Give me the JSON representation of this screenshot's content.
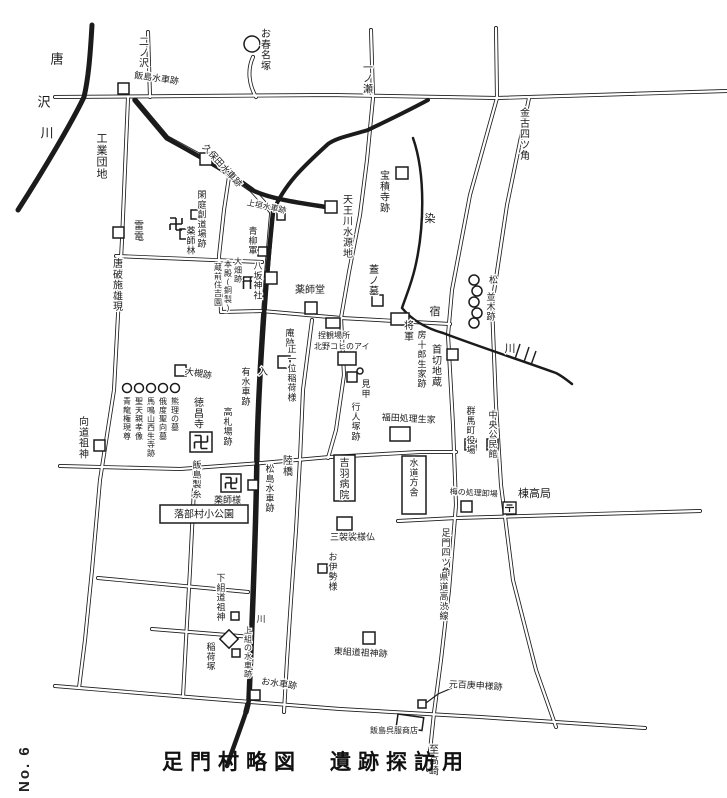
{
  "page": {
    "title": "足門村略図　遺跡探訪用",
    "page_no": "No. 6"
  },
  "colors": {
    "ink": "#1b1b1b",
    "paper": "#ffffff"
  },
  "map": {
    "rivers": [
      {
        "d": "M92,25 C90,60 88,80 84,97 C72,122 45,168 18,210",
        "w": 5
      },
      {
        "d": "M135,100 C150,118 158,128 167,138 C190,152 230,172 252,190 C270,199 300,203 326,207",
        "w": 4.5
      },
      {
        "d": "M428,100 C400,115 380,124 368,130 C348,136 336,138 328,144 C305,165 284,184 273,212",
        "w": 4
      },
      {
        "d": "M273,212 C265,290 259,370 257,450 C256,540 252,620 249,700 L246,712 C240,730 233,748 227,766",
        "w": 4.5
      },
      {
        "d": "M413,138 C426,175 424,230 415,268 C411,285 406,296 402,308 C412,320 425,328 443,333 C480,347 520,360 556,373 C562,376 567,380 572,384",
        "w": 2.5
      }
    ],
    "roads": [
      {
        "d": "M55,97 L330,95 L497,98 L727,91",
        "w": 4
      },
      {
        "d": "M148,32 L150,97",
        "w": 4
      },
      {
        "d": "M253,57 C247,70 249,85 256,97",
        "w": 4
      },
      {
        "d": "M371,30 L373,97",
        "w": 4
      },
      {
        "d": "M496,28 L497,98",
        "w": 4
      },
      {
        "d": "M497,98 L470,195 L452,290 L448,335 L453,425 L456,505 L449,590 L441,660 L434,713 L428,770",
        "w": 4
      },
      {
        "d": "M529,98 L507,205 L492,305 L496,405 L501,485 L513,580 L536,670 L556,727",
        "w": 4
      },
      {
        "d": "M373,98 L367,160 L360,215 L349,272 L341,318",
        "w": 4
      },
      {
        "d": "M341,318 L344,375 L336,430 L328,458",
        "w": 4
      },
      {
        "d": "M262,311 L341,318",
        "w": 4
      },
      {
        "d": "M341,318 L450,324",
        "w": 4
      },
      {
        "d": "M116,256 L262,262",
        "w": 4
      },
      {
        "d": "M60,466 L180,469 L262,463 L330,457 L420,452 L456,452",
        "w": 4
      },
      {
        "d": "M398,521 L456,518 L700,511",
        "w": 4
      },
      {
        "d": "M98,578 L248,592",
        "w": 4
      },
      {
        "d": "M152,629 L252,637",
        "w": 4
      },
      {
        "d": "M55,686 L200,698 L340,709 L480,717 L645,728",
        "w": 4
      },
      {
        "d": "M128,98 L122,240 L114,390 L100,480 L92,570 L85,640 L79,688",
        "w": 4
      },
      {
        "d": "M195,468 L190,570 L186,640 L183,697",
        "w": 4
      },
      {
        "d": "M312,320 L303,390 L300,459 L296,530 L291,600 L287,660 L284,712",
        "w": 4
      },
      {
        "d": "M230,170 L224,210 L219,256",
        "w": 4
      },
      {
        "d": "M219,256 L221,312 L262,311",
        "w": 4
      },
      {
        "d": "M272,212 C265,290 259,370 257,450 C256,540 252,620 249,700 L246,712",
        "w": 5.5
      },
      {
        "d": "M135,100 L167,138 L213,163 L252,190 L272,212",
        "w": 5.5
      }
    ],
    "labels": [
      {
        "t": "唐",
        "x": 57,
        "y": 52,
        "o": "v",
        "s": 13
      },
      {
        "t": "沢",
        "x": 44,
        "y": 95,
        "o": "v",
        "s": 13
      },
      {
        "t": "川",
        "x": 47,
        "y": 126,
        "o": "v",
        "s": 13
      },
      {
        "t": "二ノ沢",
        "x": 144,
        "y": 36,
        "o": "v",
        "s": 10
      },
      {
        "t": "お春名塚",
        "x": 266,
        "y": 28,
        "o": "v",
        "s": 10
      },
      {
        "t": "飯島水車跡",
        "x": 135,
        "y": 70,
        "o": "h",
        "s": 9,
        "r": 8
      },
      {
        "t": "一ノ瀬",
        "x": 368,
        "y": 62,
        "o": "v",
        "s": 10
      },
      {
        "t": "金古四ツ角",
        "x": 525,
        "y": 107,
        "o": "v",
        "s": 10
      },
      {
        "t": "工業団地",
        "x": 102,
        "y": 132,
        "o": "v",
        "s": 11
      },
      {
        "t": "久保田水車跡",
        "x": 208,
        "y": 142,
        "o": "h",
        "s": 9,
        "r": 48
      },
      {
        "t": "宝積寺跡",
        "x": 385,
        "y": 170,
        "o": "v",
        "s": 10
      },
      {
        "t": "染",
        "x": 430,
        "y": 212,
        "o": "v",
        "s": 11
      },
      {
        "t": "天王川水源地",
        "x": 348,
        "y": 194,
        "o": "v",
        "s": 10
      },
      {
        "t": "上垣水車跡",
        "x": 248,
        "y": 198,
        "o": "h",
        "s": 8,
        "r": 12
      },
      {
        "t": "青柳軍",
        "x": 253,
        "y": 226,
        "o": "v",
        "s": 9
      },
      {
        "t": "閑庭創道場跡",
        "x": 202,
        "y": 190,
        "o": "v",
        "s": 9
      },
      {
        "t": "雷電",
        "x": 139,
        "y": 220,
        "o": "v",
        "s": 10
      },
      {
        "t": "唐破施雄現",
        "x": 118,
        "y": 258,
        "o": "v",
        "s": 10
      },
      {
        "t": "薬師林",
        "x": 191,
        "y": 226,
        "o": "v",
        "s": 9
      },
      {
        "t": "大畑跡",
        "x": 238,
        "y": 257,
        "o": "v",
        "s": 8
      },
      {
        "t": "本殿(銅製)",
        "x": 228,
        "y": 260,
        "o": "v",
        "s": 8
      },
      {
        "t": "蔵前住吉園",
        "x": 218,
        "y": 263,
        "o": "v",
        "s": 8
      },
      {
        "t": "八坂神社",
        "x": 258,
        "y": 261,
        "o": "v",
        "s": 9
      },
      {
        "t": "薬師堂",
        "x": 295,
        "y": 284,
        "o": "h",
        "s": 10
      },
      {
        "t": "蓋ノ墓",
        "x": 374,
        "y": 264,
        "o": "v",
        "s": 10
      },
      {
        "t": "宿",
        "x": 435,
        "y": 305,
        "o": "v",
        "s": 11
      },
      {
        "t": "将軍",
        "x": 409,
        "y": 320,
        "o": "v",
        "s": 10
      },
      {
        "t": "房十郎生家跡",
        "x": 422,
        "y": 330,
        "o": "v",
        "s": 9
      },
      {
        "t": "首切地蔵",
        "x": 437,
        "y": 344,
        "o": "v",
        "s": 10
      },
      {
        "t": "庵跡",
        "x": 290,
        "y": 328,
        "o": "v",
        "s": 9
      },
      {
        "t": "正一位稲荷様",
        "x": 292,
        "y": 344,
        "o": "v",
        "s": 9
      },
      {
        "t": "捏観場所",
        "x": 318,
        "y": 331,
        "o": "h",
        "s": 8
      },
      {
        "t": "北野コヒのアイ",
        "x": 314,
        "y": 342,
        "o": "h",
        "s": 8
      },
      {
        "t": "見甲",
        "x": 366,
        "y": 379,
        "o": "v",
        "s": 9
      },
      {
        "t": "行人塚跡",
        "x": 356,
        "y": 402,
        "o": "v",
        "s": 9
      },
      {
        "t": "福田処理生家",
        "x": 382,
        "y": 412,
        "o": "h",
        "s": 9,
        "r": 3
      },
      {
        "t": "入",
        "x": 263,
        "y": 366,
        "o": "v",
        "s": 10
      },
      {
        "t": "有水車跡",
        "x": 246,
        "y": 367,
        "o": "v",
        "s": 9
      },
      {
        "t": "大槻跡",
        "x": 186,
        "y": 366,
        "o": "h",
        "s": 9,
        "r": 10
      },
      {
        "t": "徳昌寺",
        "x": 199,
        "y": 397,
        "o": "v",
        "s": 10
      },
      {
        "t": "高札場跡",
        "x": 228,
        "y": 407,
        "o": "v",
        "s": 9
      },
      {
        "t": "向道祖神",
        "x": 84,
        "y": 416,
        "o": "v",
        "s": 10
      },
      {
        "t": "熊理の墓",
        "x": 175,
        "y": 397,
        "o": "v",
        "s": 8
      },
      {
        "t": "俄度聖向墓",
        "x": 163,
        "y": 397,
        "o": "v",
        "s": 8
      },
      {
        "t": "馬鳴山西生寺跡",
        "x": 151,
        "y": 397,
        "o": "v",
        "s": 8
      },
      {
        "t": "聖天親孝像",
        "x": 139,
        "y": 397,
        "o": "v",
        "s": 8
      },
      {
        "t": "青龍権現尊",
        "x": 127,
        "y": 397,
        "o": "v",
        "s": 8
      },
      {
        "t": "群馬町役場",
        "x": 471,
        "y": 406,
        "o": "v",
        "s": 9
      },
      {
        "t": "中央公民館",
        "x": 493,
        "y": 410,
        "o": "v",
        "s": 9
      },
      {
        "t": "松",
        "x": 489,
        "y": 275,
        "o": "h",
        "s": 9
      },
      {
        "t": "並木跡",
        "x": 491,
        "y": 292,
        "o": "v",
        "s": 9
      },
      {
        "t": "川",
        "x": 510,
        "y": 342,
        "o": "v",
        "s": 11
      },
      {
        "t": "飯島製糸",
        "x": 197,
        "y": 460,
        "o": "v",
        "s": 9
      },
      {
        "t": "薬師様",
        "x": 214,
        "y": 495,
        "o": "h",
        "s": 9
      },
      {
        "t": "陸橋",
        "x": 288,
        "y": 455,
        "o": "v",
        "s": 10
      },
      {
        "t": "松島水車跡",
        "x": 270,
        "y": 464,
        "o": "v",
        "s": 9
      },
      {
        "t": "三袈裟様仏",
        "x": 330,
        "y": 532,
        "o": "h",
        "s": 9
      },
      {
        "t": "お伊勢様",
        "x": 333,
        "y": 552,
        "o": "v",
        "s": 9
      },
      {
        "t": "梅の処理卸場",
        "x": 450,
        "y": 487,
        "o": "h",
        "s": 8,
        "r": 3
      },
      {
        "t": "棟高局",
        "x": 518,
        "y": 487,
        "o": "h",
        "s": 11
      },
      {
        "t": "足門四ツ角",
        "x": 446,
        "y": 528,
        "o": "v",
        "s": 9
      },
      {
        "t": "県道高渋線",
        "x": 444,
        "y": 572,
        "o": "v",
        "s": 9
      },
      {
        "t": "下組道祖神",
        "x": 221,
        "y": 573,
        "o": "v",
        "s": 9
      },
      {
        "t": "稲荷塚",
        "x": 211,
        "y": 642,
        "o": "v",
        "s": 9
      },
      {
        "t": "上組の水車跡",
        "x": 248,
        "y": 626,
        "o": "v",
        "s": 8
      },
      {
        "t": "川",
        "x": 261,
        "y": 614,
        "o": "v",
        "s": 9
      },
      {
        "t": "お水車跡",
        "x": 262,
        "y": 676,
        "o": "h",
        "s": 9,
        "r": 8
      },
      {
        "t": "東組道祖神跡",
        "x": 334,
        "y": 646,
        "o": "h",
        "s": 9,
        "r": 3
      },
      {
        "t": "元百庚申様跡",
        "x": 449,
        "y": 679,
        "o": "h",
        "s": 9,
        "r": 3
      },
      {
        "t": "飯島呉服商店",
        "x": 370,
        "y": 726,
        "o": "h",
        "s": 8
      },
      {
        "t": "至高崎",
        "x": 434,
        "y": 744,
        "o": "v",
        "s": 10
      }
    ],
    "boxed_labels": [
      {
        "t": "落部村小公園",
        "x": 160,
        "y": 505,
        "w": 88,
        "h": 18,
        "o": "h",
        "s": 10
      },
      {
        "t": "吉羽病院",
        "x": 334,
        "y": 455,
        "w": 21,
        "h": 46,
        "o": "v",
        "s": 10
      },
      {
        "t": "水道方舎",
        "x": 402,
        "y": 456,
        "w": 24,
        "h": 58,
        "o": "v",
        "s": 9
      }
    ],
    "markers": [
      {
        "k": "sq",
        "x": 118,
        "y": 83,
        "w": 11
      },
      {
        "k": "sq",
        "x": 200,
        "y": 153,
        "w": 12
      },
      {
        "k": "sq",
        "x": 396,
        "y": 167,
        "w": 12
      },
      {
        "k": "sq",
        "x": 325,
        "y": 201,
        "w": 12
      },
      {
        "k": "sq",
        "x": 113,
        "y": 227,
        "w": 11
      },
      {
        "k": "sq",
        "x": 180,
        "y": 229,
        "w": 10
      },
      {
        "k": "sq",
        "x": 191,
        "y": 210,
        "w": 9
      },
      {
        "k": "sq",
        "x": 265,
        "y": 272,
        "w": 12
      },
      {
        "k": "sq",
        "x": 305,
        "y": 302,
        "w": 12
      },
      {
        "k": "sq",
        "x": 372,
        "y": 295,
        "w": 11
      },
      {
        "k": "sq",
        "x": 391,
        "y": 313,
        "w": 18,
        "h": 12
      },
      {
        "k": "sq",
        "x": 447,
        "y": 349,
        "w": 11
      },
      {
        "k": "sq",
        "x": 278,
        "y": 356,
        "w": 12
      },
      {
        "k": "sq",
        "x": 175,
        "y": 365,
        "w": 11
      },
      {
        "k": "sq",
        "x": 94,
        "y": 440,
        "w": 11
      },
      {
        "k": "sq",
        "x": 248,
        "y": 480,
        "w": 10
      },
      {
        "k": "sq",
        "x": 337,
        "y": 517,
        "w": 15,
        "h": 13
      },
      {
        "k": "sq",
        "x": 318,
        "y": 564,
        "w": 9
      },
      {
        "k": "sq",
        "x": 461,
        "y": 501,
        "w": 11
      },
      {
        "k": "sq",
        "x": 465,
        "y": 439,
        "w": 11
      },
      {
        "k": "sq",
        "x": 487,
        "y": 439,
        "w": 11
      },
      {
        "k": "sq",
        "x": 390,
        "y": 427,
        "w": 20,
        "h": 14
      },
      {
        "k": "sq",
        "x": 363,
        "y": 632,
        "w": 12
      },
      {
        "k": "sq",
        "x": 418,
        "y": 700,
        "w": 8
      },
      {
        "k": "sq",
        "x": 231,
        "y": 612,
        "w": 8
      },
      {
        "k": "sq",
        "x": 232,
        "y": 649,
        "w": 8
      },
      {
        "k": "sq",
        "x": 250,
        "y": 690,
        "w": 10
      },
      {
        "k": "sq",
        "x": 258,
        "y": 247,
        "w": 9
      },
      {
        "k": "sq",
        "x": 277,
        "y": 212,
        "w": 8
      },
      {
        "k": "sq",
        "x": 326,
        "y": 318,
        "w": 14,
        "h": 10
      },
      {
        "k": "sq",
        "x": 338,
        "y": 352,
        "w": 18,
        "h": 13
      },
      {
        "k": "sq",
        "x": 347,
        "y": 372,
        "w": 10
      },
      {
        "k": "sq",
        "x": 398,
        "y": 714,
        "w": 26,
        "h": 13,
        "rot": 8
      },
      {
        "k": "boxmanji",
        "x": 190,
        "y": 432,
        "w": 22,
        "h": 20
      },
      {
        "k": "boxmanji",
        "x": 221,
        "y": 474,
        "w": 20,
        "h": 18
      },
      {
        "k": "manji",
        "cx": 176,
        "cy": 224,
        "s": 6
      },
      {
        "k": "torii",
        "cx": 247,
        "cy": 282
      },
      {
        "k": "postal",
        "x": 503,
        "y": 502,
        "w": 13,
        "h": 12
      },
      {
        "k": "diamond",
        "cx": 229,
        "cy": 639,
        "w": 13
      },
      {
        "k": "circle",
        "cx": 252,
        "cy": 44,
        "r": 8
      },
      {
        "k": "circle",
        "cx": 360,
        "cy": 371,
        "r": 3
      },
      {
        "k": "circle",
        "cx": 175,
        "cy": 388,
        "r": 4.5
      },
      {
        "k": "circle",
        "cx": 163,
        "cy": 388,
        "r": 4.5
      },
      {
        "k": "circle",
        "cx": 151,
        "cy": 388,
        "r": 4.5
      },
      {
        "k": "circle",
        "cx": 139,
        "cy": 388,
        "r": 4.5
      },
      {
        "k": "circle",
        "cx": 127,
        "cy": 388,
        "r": 4.5
      },
      {
        "k": "circle",
        "cx": 474,
        "cy": 280,
        "r": 5
      },
      {
        "k": "circle",
        "cx": 477,
        "cy": 291,
        "r": 5
      },
      {
        "k": "circle",
        "cx": 474,
        "cy": 302,
        "r": 5
      },
      {
        "k": "circle",
        "cx": 477,
        "cy": 313,
        "r": 5
      },
      {
        "k": "circle",
        "cx": 474,
        "cy": 323,
        "r": 5
      }
    ],
    "leaders": [
      {
        "d": "M452,688 L438,694 L426,703"
      }
    ],
    "ticks": [
      {
        "d": "M520,344 L515,359"
      },
      {
        "d": "M529,347 L524,362"
      },
      {
        "d": "M536,351 L531,365"
      }
    ]
  }
}
